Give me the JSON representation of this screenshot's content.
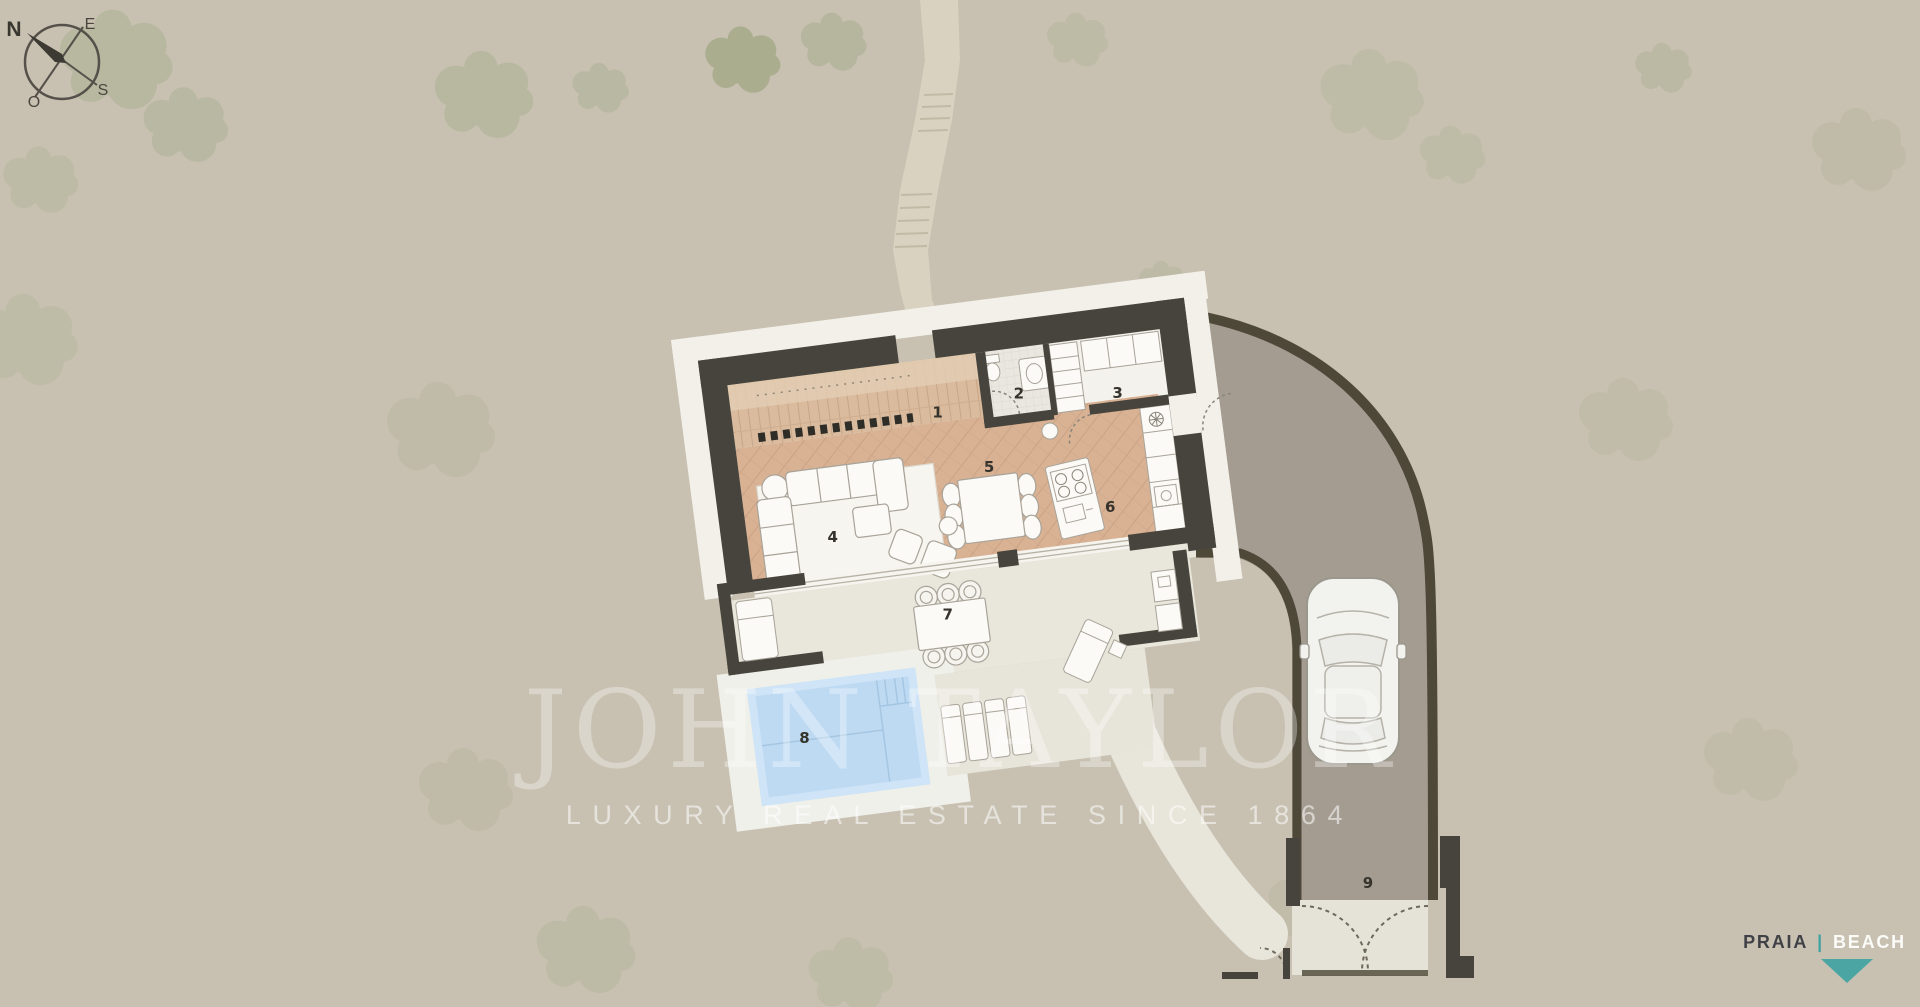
{
  "compass": {
    "north": "N",
    "east": "E",
    "south": "S",
    "west": "O"
  },
  "room_labels": [
    "1",
    "2",
    "3",
    "4",
    "5",
    "6",
    "7",
    "8",
    "9"
  ],
  "watermark": {
    "brand": "JOHN TAYLOR",
    "tagline": "LUXURY REAL ESTATE SINCE 1864"
  },
  "direction_banner": {
    "primary": "PRAIA",
    "separator": "|",
    "secondary": "BEACH"
  },
  "colors": {
    "background": "#c8c1b2",
    "wall": "#46443c",
    "pool_water": "#bedaf3",
    "accent_teal": "#4ba6a3",
    "driveway": "#a49c91",
    "parquet": "#d9b294",
    "deck": "#dabb9e"
  }
}
